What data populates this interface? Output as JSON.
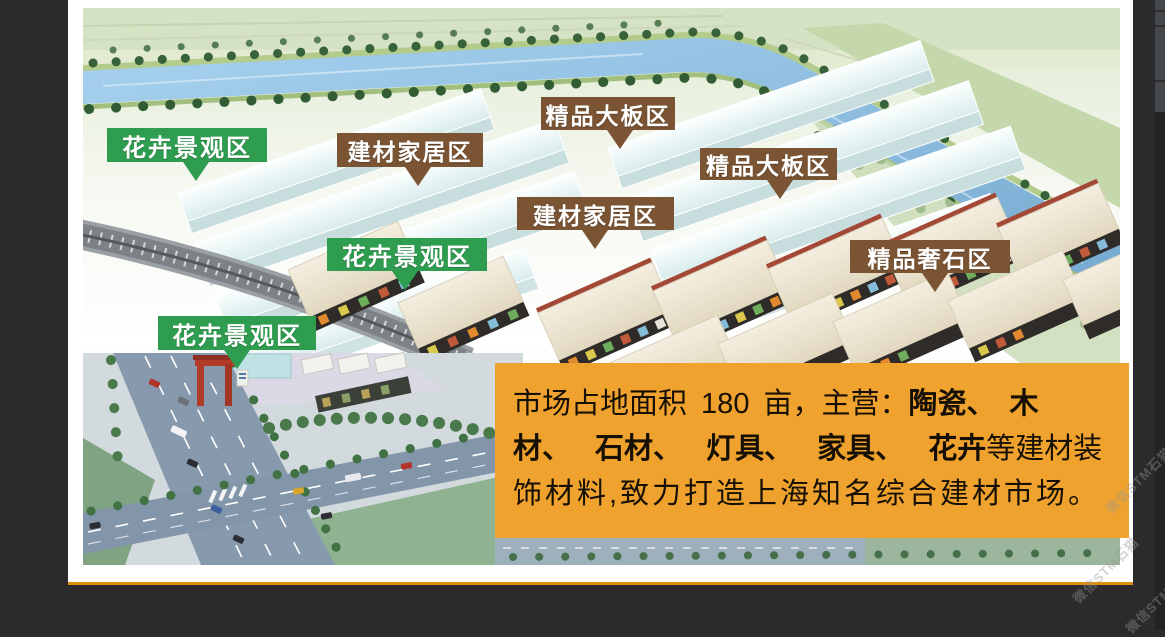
{
  "window": {
    "description_note": "aerial rendering of building-materials market with zone flags"
  },
  "colors": {
    "page_bg": "#2b2b2d",
    "card_bg": "#ffffff",
    "card_line": "#de8f07",
    "green_label": "#2f9d50",
    "brown_label": "#7a5433",
    "orange_panel": "#f0a22e"
  },
  "zone_labels": [
    {
      "label": "花卉景观区",
      "type": "green"
    },
    {
      "label": "建材家居区",
      "type": "brown"
    },
    {
      "label": "精品大板区",
      "type": "brown"
    },
    {
      "label": "精品大板区",
      "type": "brown"
    },
    {
      "label": "建材家居区",
      "type": "brown"
    },
    {
      "label": "花卉景观区",
      "type": "green"
    },
    {
      "label": "花卉景观区",
      "type": "green"
    },
    {
      "label": "精品奢石区",
      "type": "brown"
    }
  ],
  "info_box": {
    "lines": [
      {
        "pre": "市场占地面积 180 亩，主营：",
        "bold": "陶瓷、 木",
        "post": ""
      },
      {
        "pre": "",
        "bold": "材、 石材、 灯具、 家具、 花卉",
        "post": "等建材装"
      },
      {
        "pre": "饰材料,致力打造上海知名综合建材市场。",
        "bold": "",
        "post": ""
      }
    ]
  },
  "watermark": {
    "text": "微信STM石猫"
  }
}
